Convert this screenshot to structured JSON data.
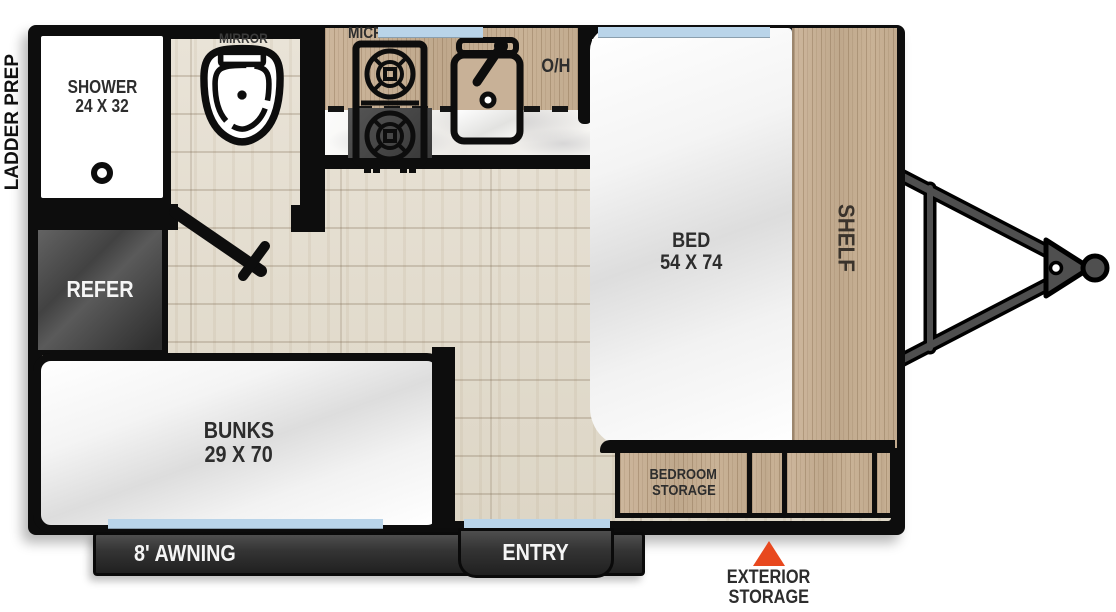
{
  "plan": {
    "exterior": {
      "ladder_prep": "LADDER PREP",
      "awning": "8' AWNING",
      "entry": "ENTRY",
      "exterior_storage_line1": "EXTERIOR",
      "exterior_storage_line2": "STORAGE"
    },
    "rooms": {
      "shower_line1": "SHOWER",
      "shower_line2": "24 X 32",
      "mirror": "MIRROR",
      "microwave": "MICROWAVE",
      "overhead_cabinet": "O/H",
      "refer": "REFER",
      "bed_line1": "BED",
      "bed_line2": "54 X 74",
      "shelf": "SHELF",
      "bunks_line1": "BUNKS",
      "bunks_line2": "29 X 70",
      "bedroom_storage_line1": "BEDROOM",
      "bedroom_storage_line2": "STORAGE"
    },
    "icons": {
      "toilet": "toilet-top-view",
      "cooktop": "two-burner-cooktop",
      "sink": "sink-with-faucet",
      "shower_drain": "shower-drain",
      "door": "entry-door-swing",
      "hitch": "trailer-tongue-hitch",
      "exterior_storage_marker": "orange-triangle-marker",
      "window": "window-marker"
    },
    "colors": {
      "wall": "#0d0d0d",
      "window_blue": "#b9d4e9",
      "cabinet_wood": "#c8b197",
      "floor_wood": "#e3ddd0",
      "marker_orange": "#e8481e",
      "label_dark": "#2d2d2d",
      "band_dark": "#3a3a3a"
    }
  }
}
